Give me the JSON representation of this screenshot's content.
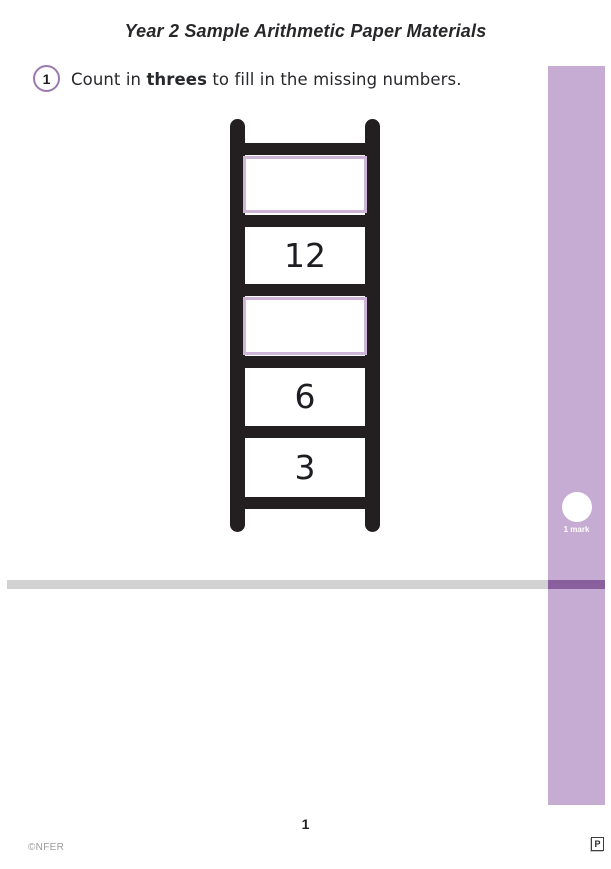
{
  "page": {
    "title": "Year 2 Sample Arithmetic Paper Materials",
    "page_number": "1",
    "copyright": "©NFER",
    "corner_badge": "P"
  },
  "question": {
    "number": "1",
    "text_prefix": "Count in ",
    "text_bold": "threes",
    "text_suffix": " to fill in the missing numbers."
  },
  "ladder": {
    "cells": [
      {
        "value": "",
        "kind": "answer-box"
      },
      {
        "value": "12",
        "kind": "given"
      },
      {
        "value": "",
        "kind": "answer-box"
      },
      {
        "value": "6",
        "kind": "given"
      },
      {
        "value": "3",
        "kind": "given"
      }
    ]
  },
  "marks": {
    "label": "1 mark"
  },
  "colors": {
    "margin_strip": "#c6abd2",
    "divider_accent": "#8a5f9e",
    "divider_gray": "#d2d2d2",
    "question_circle_ring": "#9b79ad",
    "answer_box_border": "#cfb6d8",
    "ladder_black": "#231f20"
  }
}
